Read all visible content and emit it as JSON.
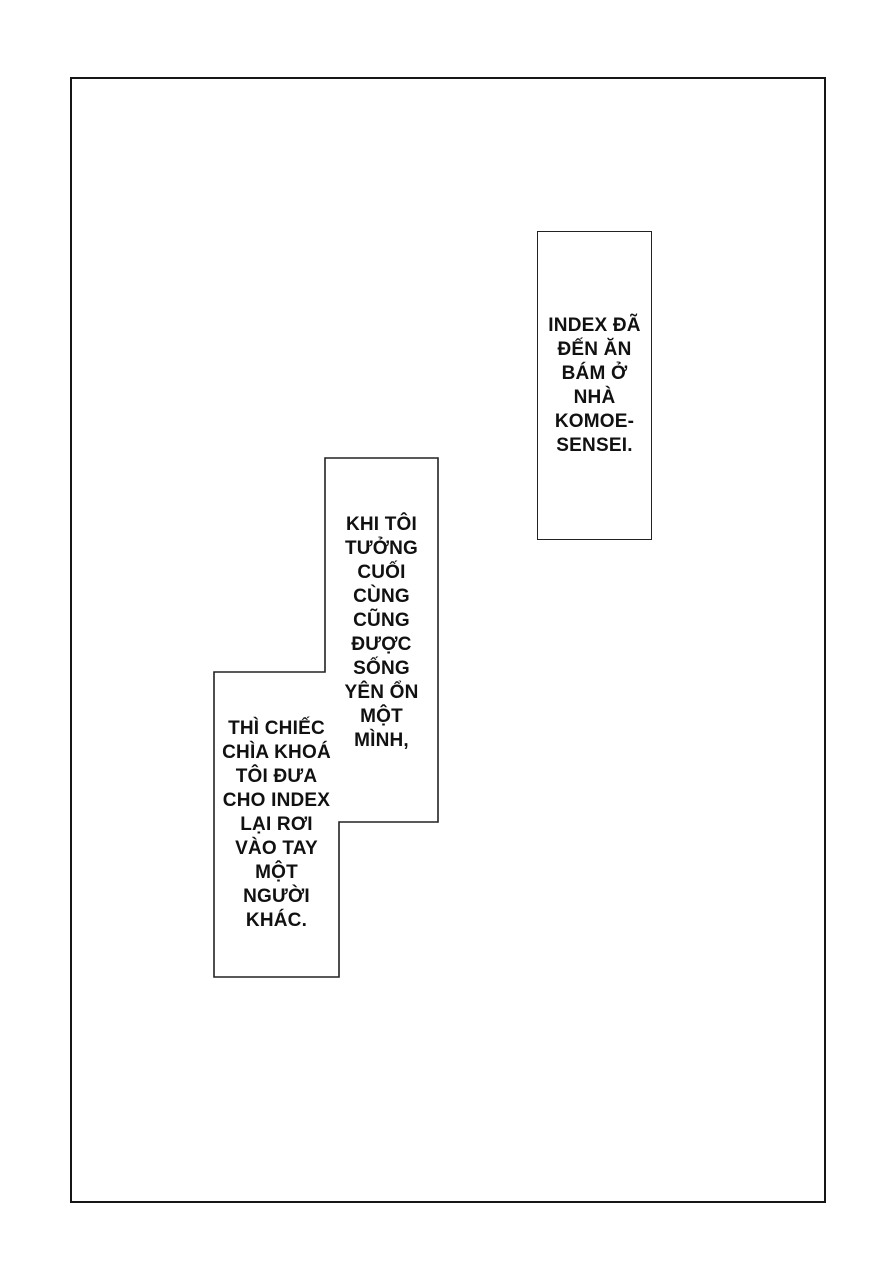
{
  "page": {
    "type": "manga-page",
    "colors": {
      "paper": "#ffffff",
      "ink": "#1c1c1c"
    }
  },
  "bubbles": [
    {
      "id": "bubble-komoe",
      "text": "INDEX ĐÃ\nĐẾN ĂN\nBÁM Ở\nNHÀ\nKOMOE-\nSENSEI."
    },
    {
      "id": "bubble-alone",
      "text": "KHI TÔI\nTƯỞNG\nCUỐI\nCÙNG\nCŨNG\nĐƯỢC\nSỐNG\nYÊN ỔN\nMỘT\nMÌNH,"
    },
    {
      "id": "bubble-key",
      "text": "THÌ CHIẾC\nCHÌA KHOÁ\nTÔI ĐƯA\nCHO INDEX\nLẠI RƠI\nVÀO TAY\nMỘT\nNGƯỜI\nKHÁC."
    }
  ]
}
